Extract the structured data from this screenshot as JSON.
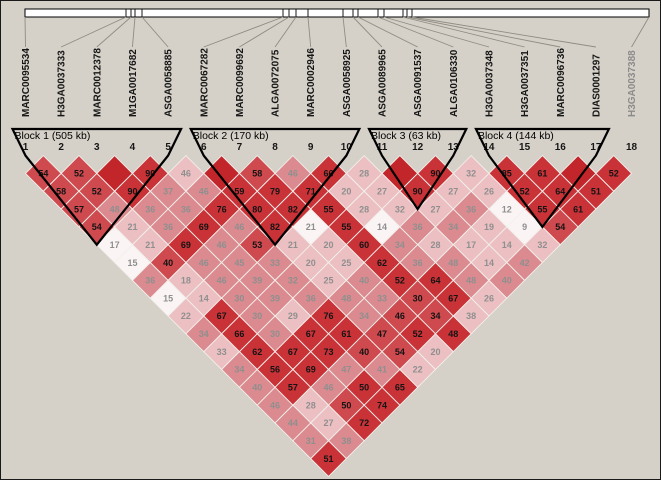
{
  "colors": {
    "background": "#d5d1c8",
    "tones": {
      "s": "#c2262b",
      "d": "#c93338",
      "m": "#cf4a4f",
      "p": "#db8b8f",
      "l": "#ecc0c2",
      "w": "#faf4f4"
    },
    "cell_text_dark": "#141414",
    "cell_text_light": "#8f8f8f",
    "light_text_tones": [
      "p",
      "l",
      "w"
    ],
    "block_outline": "#000000",
    "connector_line": "#8f8c84",
    "chromosome_bar_fill": "#ffffff",
    "chromosome_bar_stroke": "#000000",
    "marker_label": "#161616",
    "marker_label_muted": "#8b8b8b",
    "cell_border": "#f2f0ec"
  },
  "chart_data": {
    "type": "heatmap",
    "title": "Haploview linkage disequilibrium (D') plot",
    "markers": [
      {
        "num": "1",
        "name": "MARC0095534",
        "muted": false
      },
      {
        "num": "2",
        "name": "H3GA0037333",
        "muted": false
      },
      {
        "num": "3",
        "name": "MARC0012378",
        "muted": false
      },
      {
        "num": "4",
        "name": "M1GA0017682",
        "muted": false
      },
      {
        "num": "5",
        "name": "ASGA0058885",
        "muted": false
      },
      {
        "num": "6",
        "name": "MARC0067282",
        "muted": false
      },
      {
        "num": "7",
        "name": "MARC0099692",
        "muted": false
      },
      {
        "num": "8",
        "name": "ALGA0072075",
        "muted": false
      },
      {
        "num": "9",
        "name": "MARC0002946",
        "muted": false
      },
      {
        "num": "10",
        "name": "ASGA0058925",
        "muted": false
      },
      {
        "num": "11",
        "name": "ASGA0089965",
        "muted": false
      },
      {
        "num": "12",
        "name": "ASGA0091537",
        "muted": false
      },
      {
        "num": "13",
        "name": "ALGA0106330",
        "muted": false
      },
      {
        "num": "14",
        "name": "H3GA0037348",
        "muted": false
      },
      {
        "num": "15",
        "name": "H3GA0037351",
        "muted": false
      },
      {
        "num": "16",
        "name": "MARC0096736",
        "muted": false
      },
      {
        "num": "17",
        "name": "DIAS0001297",
        "muted": false
      },
      {
        "num": "18",
        "name": "H3GA0037388",
        "muted": true
      }
    ],
    "blocks": [
      {
        "label": "Block 1 (505 kb)",
        "start": 1,
        "end": 5
      },
      {
        "label": "Block 2 (170 kb)",
        "start": 6,
        "end": 10
      },
      {
        "label": "Block 3 (63 kb)",
        "start": 11,
        "end": 13
      },
      {
        "label": "Block 4 (144 kb)",
        "start": 14,
        "end": 17
      }
    ],
    "ruler": {
      "x_start": 24,
      "x_end": 648,
      "tick_x": [
        24,
        125,
        130,
        134,
        141,
        282,
        288,
        295,
        307,
        342,
        352,
        357,
        377,
        383,
        402,
        406,
        411,
        648
      ]
    },
    "ld_rows": [
      {
        "d": 1,
        "cells": [
          [
            1,
            2,
            54,
            "m"
          ],
          [
            2,
            3,
            52,
            "m"
          ],
          [
            3,
            4,
            null,
            "s"
          ],
          [
            4,
            5,
            90,
            "d"
          ],
          [
            5,
            6,
            46,
            "l"
          ],
          [
            6,
            7,
            null,
            "s"
          ],
          [
            7,
            8,
            58,
            "m"
          ],
          [
            8,
            9,
            46,
            "p"
          ],
          [
            9,
            10,
            66,
            "d"
          ],
          [
            10,
            11,
            28,
            "l"
          ],
          [
            11,
            12,
            null,
            "s"
          ],
          [
            12,
            13,
            90,
            "d"
          ],
          [
            13,
            14,
            32,
            "l"
          ],
          [
            14,
            15,
            85,
            "d"
          ],
          [
            15,
            16,
            61,
            "d"
          ],
          [
            16,
            17,
            null,
            "s"
          ],
          [
            17,
            18,
            52,
            "d"
          ]
        ]
      },
      {
        "d": 2,
        "cells": [
          [
            1,
            3,
            58,
            "m"
          ],
          [
            2,
            4,
            52,
            "m"
          ],
          [
            3,
            5,
            90,
            "d"
          ],
          [
            4,
            6,
            37,
            "p"
          ],
          [
            5,
            7,
            46,
            "p"
          ],
          [
            6,
            8,
            59,
            "d"
          ],
          [
            7,
            9,
            79,
            "d"
          ],
          [
            8,
            10,
            71,
            "d"
          ],
          [
            9,
            11,
            20,
            "l"
          ],
          [
            10,
            12,
            27,
            "l"
          ],
          [
            11,
            13,
            90,
            "d"
          ],
          [
            12,
            14,
            27,
            "l"
          ],
          [
            13,
            15,
            26,
            "l"
          ],
          [
            14,
            16,
            52,
            "d"
          ],
          [
            15,
            17,
            64,
            "d"
          ],
          [
            16,
            18,
            51,
            "d"
          ]
        ]
      },
      {
        "d": 3,
        "cells": [
          [
            1,
            4,
            57,
            "m"
          ],
          [
            2,
            5,
            48,
            "p"
          ],
          [
            3,
            6,
            36,
            "p"
          ],
          [
            4,
            7,
            36,
            "p"
          ],
          [
            5,
            8,
            76,
            "d"
          ],
          [
            6,
            9,
            80,
            "d"
          ],
          [
            7,
            10,
            82,
            "d"
          ],
          [
            8,
            11,
            55,
            "d"
          ],
          [
            9,
            12,
            28,
            "l"
          ],
          [
            10,
            13,
            32,
            "l"
          ],
          [
            11,
            14,
            27,
            "l"
          ],
          [
            12,
            15,
            36,
            "p"
          ],
          [
            13,
            16,
            12,
            "w"
          ],
          [
            14,
            17,
            55,
            "d"
          ],
          [
            15,
            18,
            61,
            "d"
          ]
        ]
      },
      {
        "d": 4,
        "cells": [
          [
            1,
            5,
            54,
            "m"
          ],
          [
            2,
            6,
            21,
            "l"
          ],
          [
            3,
            7,
            36,
            "p"
          ],
          [
            4,
            8,
            69,
            "d"
          ],
          [
            5,
            9,
            46,
            "p"
          ],
          [
            6,
            10,
            82,
            "d"
          ],
          [
            7,
            11,
            21,
            "w"
          ],
          [
            8,
            12,
            55,
            "d"
          ],
          [
            9,
            13,
            14,
            "w"
          ],
          [
            10,
            14,
            36,
            "p"
          ],
          [
            11,
            15,
            34,
            "p"
          ],
          [
            12,
            16,
            19,
            "l"
          ],
          [
            13,
            17,
            9,
            "w"
          ],
          [
            14,
            18,
            54,
            "m"
          ]
        ]
      },
      {
        "d": 5,
        "cells": [
          [
            1,
            6,
            17,
            "w"
          ],
          [
            2,
            7,
            21,
            "l"
          ],
          [
            3,
            8,
            69,
            "d"
          ],
          [
            4,
            9,
            46,
            "p"
          ],
          [
            5,
            10,
            53,
            "m"
          ],
          [
            6,
            11,
            21,
            "l"
          ],
          [
            7,
            12,
            20,
            "l"
          ],
          [
            8,
            13,
            60,
            "d"
          ],
          [
            9,
            14,
            34,
            "p"
          ],
          [
            10,
            15,
            28,
            "l"
          ],
          [
            11,
            16,
            17,
            "l"
          ],
          [
            12,
            17,
            14,
            "l"
          ],
          [
            13,
            18,
            32,
            "l"
          ]
        ]
      },
      {
        "d": 6,
        "cells": [
          [
            1,
            7,
            15,
            "w"
          ],
          [
            2,
            8,
            40,
            "m"
          ],
          [
            3,
            9,
            46,
            "p"
          ],
          [
            4,
            10,
            45,
            "p"
          ],
          [
            5,
            11,
            33,
            "p"
          ],
          [
            6,
            12,
            20,
            "l"
          ],
          [
            7,
            13,
            25,
            "l"
          ],
          [
            8,
            14,
            62,
            "d"
          ],
          [
            9,
            15,
            36,
            "p"
          ],
          [
            10,
            16,
            48,
            "p"
          ],
          [
            11,
            17,
            14,
            "l"
          ],
          [
            12,
            18,
            42,
            "p"
          ]
        ]
      },
      {
        "d": 7,
        "cells": [
          [
            1,
            8,
            36,
            "p"
          ],
          [
            2,
            9,
            18,
            "l"
          ],
          [
            3,
            10,
            46,
            "p"
          ],
          [
            4,
            11,
            39,
            "p"
          ],
          [
            5,
            12,
            32,
            "p"
          ],
          [
            6,
            13,
            25,
            "l"
          ],
          [
            7,
            14,
            40,
            "p"
          ],
          [
            8,
            15,
            52,
            "d"
          ],
          [
            9,
            16,
            64,
            "d"
          ],
          [
            10,
            17,
            48,
            "p"
          ],
          [
            11,
            18,
            40,
            "p"
          ]
        ]
      },
      {
        "d": 8,
        "cells": [
          [
            1,
            9,
            15,
            "w"
          ],
          [
            2,
            10,
            14,
            "l"
          ],
          [
            3,
            11,
            30,
            "p"
          ],
          [
            4,
            12,
            39,
            "p"
          ],
          [
            5,
            13,
            36,
            "p"
          ],
          [
            6,
            14,
            48,
            "p"
          ],
          [
            7,
            15,
            33,
            "p"
          ],
          [
            8,
            16,
            30,
            "m"
          ],
          [
            9,
            17,
            67,
            "d"
          ],
          [
            10,
            18,
            26,
            "l"
          ]
        ]
      },
      {
        "d": 9,
        "cells": [
          [
            1,
            10,
            22,
            "l"
          ],
          [
            2,
            11,
            67,
            "d"
          ],
          [
            3,
            12,
            30,
            "p"
          ],
          [
            4,
            13,
            29,
            "l"
          ],
          [
            5,
            14,
            76,
            "d"
          ],
          [
            6,
            15,
            34,
            "p"
          ],
          [
            7,
            16,
            46,
            "m"
          ],
          [
            8,
            17,
            34,
            "m"
          ],
          [
            9,
            18,
            38,
            "l"
          ]
        ]
      },
      {
        "d": 10,
        "cells": [
          [
            1,
            11,
            34,
            "p"
          ],
          [
            2,
            12,
            66,
            "d"
          ],
          [
            3,
            13,
            30,
            "p"
          ],
          [
            4,
            14,
            67,
            "d"
          ],
          [
            5,
            15,
            61,
            "d"
          ],
          [
            6,
            16,
            47,
            "m"
          ],
          [
            7,
            17,
            52,
            "d"
          ],
          [
            8,
            18,
            48,
            "d"
          ]
        ]
      },
      {
        "d": 11,
        "cells": [
          [
            1,
            12,
            33,
            "l"
          ],
          [
            2,
            13,
            62,
            "d"
          ],
          [
            3,
            14,
            67,
            "d"
          ],
          [
            4,
            15,
            73,
            "d"
          ],
          [
            5,
            16,
            40,
            "m"
          ],
          [
            6,
            17,
            54,
            "m"
          ],
          [
            7,
            18,
            20,
            "l"
          ]
        ]
      },
      {
        "d": 12,
        "cells": [
          [
            1,
            13,
            34,
            "p"
          ],
          [
            2,
            14,
            56,
            "d"
          ],
          [
            3,
            15,
            69,
            "d"
          ],
          [
            4,
            16,
            47,
            "p"
          ],
          [
            5,
            17,
            41,
            "p"
          ],
          [
            6,
            18,
            22,
            "l"
          ]
        ]
      },
      {
        "d": 13,
        "cells": [
          [
            1,
            14,
            40,
            "p"
          ],
          [
            2,
            15,
            57,
            "d"
          ],
          [
            3,
            16,
            46,
            "p"
          ],
          [
            4,
            17,
            50,
            "d"
          ],
          [
            5,
            18,
            65,
            "d"
          ]
        ]
      },
      {
        "d": 14,
        "cells": [
          [
            1,
            15,
            46,
            "p"
          ],
          [
            2,
            16,
            28,
            "l"
          ],
          [
            3,
            17,
            50,
            "m"
          ],
          [
            4,
            18,
            74,
            "d"
          ]
        ]
      },
      {
        "d": 15,
        "cells": [
          [
            1,
            16,
            44,
            "p"
          ],
          [
            2,
            17,
            27,
            "l"
          ],
          [
            3,
            18,
            72,
            "d"
          ]
        ]
      },
      {
        "d": 16,
        "cells": [
          [
            1,
            17,
            31,
            "p"
          ],
          [
            2,
            18,
            38,
            "p"
          ]
        ]
      },
      {
        "d": 17,
        "cells": [
          [
            1,
            18,
            51,
            "d"
          ]
        ]
      }
    ]
  }
}
